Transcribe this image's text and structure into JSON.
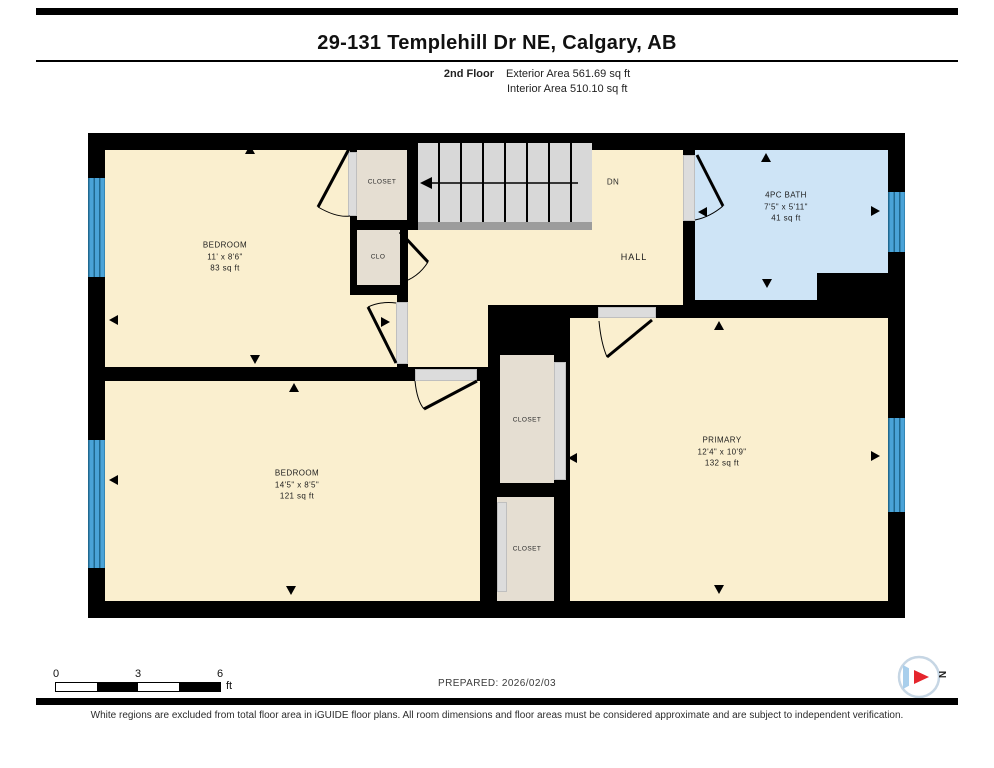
{
  "header": {
    "title": "29-131 Templehill Dr NE, Calgary, AB",
    "floor_label": "2nd Floor",
    "exterior_area": "Exterior Area 561.69 sq ft",
    "interior_area": "Interior Area 510.10 sq ft"
  },
  "plan": {
    "rooms": {
      "bedroom_top": {
        "name": "BEDROOM",
        "dims": "11' x 8'6\"",
        "area": "83 sq ft"
      },
      "bedroom_bottom": {
        "name": "BEDROOM",
        "dims": "14'5\" x 8'5\"",
        "area": "121 sq ft"
      },
      "primary": {
        "name": "PRIMARY",
        "dims": "12'4\" x 10'9\"",
        "area": "132 sq ft"
      },
      "bath": {
        "name": "4PC BATH",
        "dims": "7'5\" x 5'11\"",
        "area": "41 sq ft"
      },
      "closet_top": {
        "name": "CLOSET"
      },
      "closet_small": {
        "name": "CLO"
      },
      "closet_mid": {
        "name": "CLOSET"
      },
      "closet_bottom": {
        "name": "CLOSET"
      },
      "hall": {
        "name": "HALL"
      },
      "stairs": {
        "label": "DN"
      }
    }
  },
  "scale_bar": {
    "start": "0",
    "mid": "3",
    "end": "6",
    "unit": "ft"
  },
  "footer": {
    "prepared": "PREPARED: 2026/02/03",
    "disclaimer": "White regions are excluded from total floor area in iGUIDE floor plans. All room dimensions and floor areas must be considered approximate and are subject to independent verification.",
    "compass_label": "N"
  },
  "colors": {
    "room_fill": "#FAEFCF",
    "closet_fill": "#E5DED2",
    "bath_fill": "#CEE4F6",
    "window_blue": "#4AA3D8",
    "wall": "#000000",
    "stairs_fill": "#D8D8D8",
    "compass_red": "#E5252C"
  }
}
